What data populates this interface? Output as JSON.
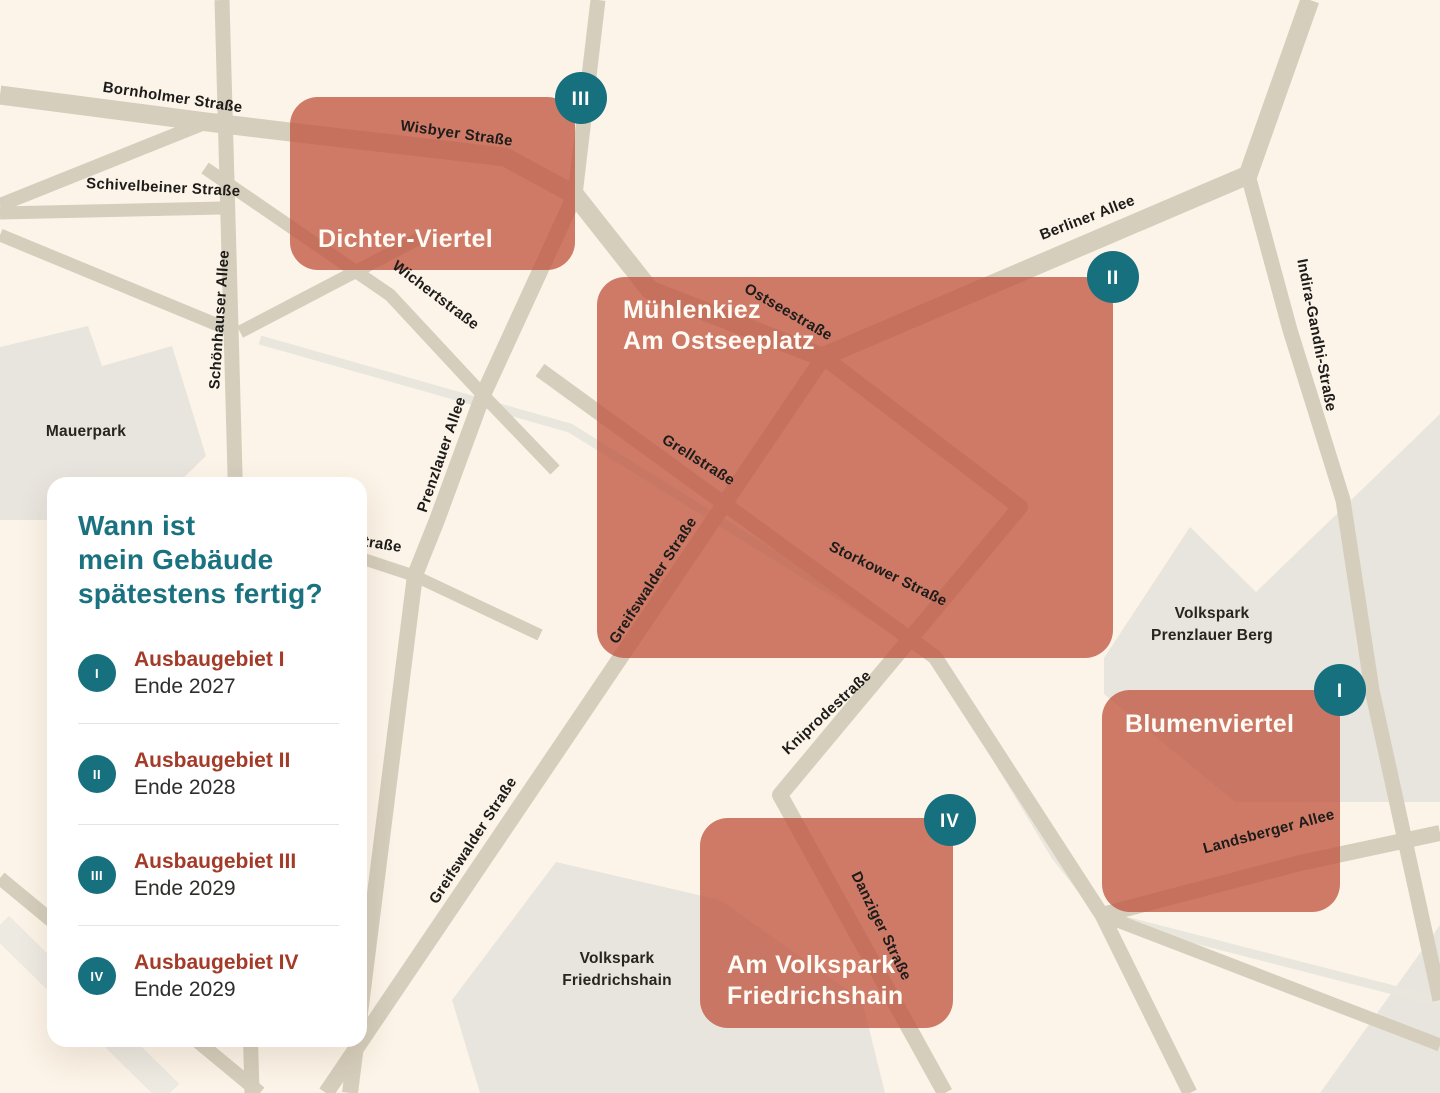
{
  "map": {
    "colors": {
      "background": "#fcf4e8",
      "street": "#d5cebc",
      "rail": "#e9e6dd",
      "rail_wide": "#edeae2",
      "park": "#e8e5de",
      "area": "#c05742",
      "area_opacity": 0.78,
      "badge": "#17707e",
      "street_label": "#1d1c1a",
      "area_label": "#fefaf4"
    },
    "parks": [
      {
        "id": "mauerpark",
        "points": "0,347 88,326 102,366 172,346 206,456 140,520 0,520"
      },
      {
        "id": "volkspark-prenzlauer-berg",
        "points": "1104,658 1190,527 1256,592 1440,414 1440,802 1235,802 1104,694"
      },
      {
        "id": "volkspark-friedrichshain",
        "points": "556,862 720,900 862,1000 885,1093 480,1093 452,1000"
      },
      {
        "id": "gray-bottom-right",
        "points": "1320,1093 1440,925 1440,1093"
      }
    ],
    "rails": [
      {
        "id": "ringbahn",
        "points": "260,340 570,428 935,655 1055,855 1102,915 1440,1002",
        "width": 9
      },
      {
        "id": "rail-bottom-left",
        "points": "0,925 170,1093",
        "width": 26,
        "wide": true
      }
    ],
    "streets": [
      {
        "id": "wisbyer-ostsee-berliner",
        "points": "0,95 207,122 290,132 505,157 575,195 650,290 822,357 1248,175 1310,0",
        "width": 19
      },
      {
        "id": "bornholmer-bruecke",
        "points": "0,205 207,122",
        "width": 14
      },
      {
        "id": "schivelbeiner-strasse",
        "points": "0,213 222,208",
        "width": 13
      },
      {
        "id": "schoenhauser-allee",
        "points": "222,0 252,1093",
        "width": 15
      },
      {
        "id": "top-vertical",
        "points": "598,0 575,195",
        "width": 15
      },
      {
        "id": "indira-gandhi-strasse",
        "points": "1248,175 1290,330 1343,500 1372,690 1440,1000",
        "width": 15
      },
      {
        "id": "prenzlauer-allee",
        "points": "575,195 483,395 437,520 415,575 350,1093",
        "width": 16
      },
      {
        "id": "wichertstrasse",
        "points": "205,168 390,295 483,395 555,470",
        "width": 13
      },
      {
        "id": "kuglerstrasse",
        "points": "420,238 240,332",
        "width": 13
      },
      {
        "id": "gleimstrasse",
        "points": "0,235 230,330",
        "width": 13
      },
      {
        "id": "greifswalder-strasse",
        "points": "825,355 326,1093",
        "width": 16
      },
      {
        "id": "grell-storkower",
        "points": "540,370 730,508 935,657 1102,915 1190,1093",
        "width": 15
      },
      {
        "id": "kniprode-danziger",
        "points": "830,362 1020,507 780,795 945,1093",
        "width": 16
      },
      {
        "id": "landsberger-allee",
        "points": "1102,915 1300,863 1440,833",
        "width": 16
      },
      {
        "id": "landsberger-sued-ost",
        "points": "1102,915 1440,1045",
        "width": 13
      },
      {
        "id": "strasse-partial",
        "points": "330,548 415,576 540,635",
        "width": 12
      },
      {
        "id": "bottom-left-diagonal",
        "points": "0,878 260,1093",
        "width": 14
      }
    ],
    "areas": [
      {
        "id": "dichter-viertel",
        "x": 290,
        "y": 97,
        "w": 285,
        "h": 173,
        "label_lines": [
          "Dichter-Viertel"
        ],
        "label_x": 318,
        "label_y": 247,
        "badge": {
          "numeral": "III",
          "cx": 581,
          "cy": 98
        }
      },
      {
        "id": "muehlenkiez-am-ostseeplatz",
        "x": 597,
        "y": 277,
        "w": 516,
        "h": 381,
        "label_lines": [
          "Mühlenkiez",
          "Am Ostseeplatz"
        ],
        "label_x": 623,
        "label_y": 318,
        "badge": {
          "numeral": "II",
          "cx": 1113,
          "cy": 277
        }
      },
      {
        "id": "blumenviertel",
        "x": 1102,
        "y": 690,
        "w": 238,
        "h": 222,
        "label_lines": [
          "Blumenviertel"
        ],
        "label_x": 1125,
        "label_y": 732,
        "badge": {
          "numeral": "I",
          "cx": 1340,
          "cy": 690
        }
      },
      {
        "id": "am-volkspark-friedrichshain",
        "x": 700,
        "y": 818,
        "w": 253,
        "h": 210,
        "label_lines": [
          "Am Volkspark",
          "Friedrichshain"
        ],
        "label_x": 727,
        "label_y": 973,
        "badge": {
          "numeral": "IV",
          "cx": 950,
          "cy": 820
        }
      }
    ],
    "street_labels": [
      {
        "text": "Bornholmer Straße",
        "x": 172,
        "y": 102,
        "rot": 8.5
      },
      {
        "text": "Schivelbeiner Straße",
        "x": 163,
        "y": 192,
        "rot": 3
      },
      {
        "text": "Schönhauser Allee",
        "x": 224,
        "y": 320,
        "rot": -86
      },
      {
        "text": "Wisbyer Straße",
        "x": 456,
        "y": 138,
        "rot": 8
      },
      {
        "text": "Wichertstraße",
        "x": 433,
        "y": 299,
        "rot": 37
      },
      {
        "text": "Prenzlauer Allee",
        "x": 446,
        "y": 456,
        "rot": -71
      },
      {
        "text": "traße",
        "x": 382,
        "y": 549,
        "rot": 9
      },
      {
        "text": "Ostseestraße",
        "x": 786,
        "y": 316,
        "rot": 30
      },
      {
        "text": "Berliner Allee",
        "x": 1089,
        "y": 222,
        "rot": -21
      },
      {
        "text": "Indira-Gandhi-Straße",
        "x": 1312,
        "y": 336,
        "rot": 79
      },
      {
        "text": "Grellstraße",
        "x": 696,
        "y": 464,
        "rot": 32
      },
      {
        "text": "Greifswalder Straße",
        "x": 657,
        "y": 583,
        "rot": -57
      },
      {
        "text": "Storkower Straße",
        "x": 886,
        "y": 578,
        "rot": 26
      },
      {
        "text": "Kniprodestraße",
        "x": 830,
        "y": 716,
        "rot": -43
      },
      {
        "text": "Greifswalder Straße",
        "x": 477,
        "y": 843,
        "rot": -57
      },
      {
        "text": "Danziger Straße",
        "x": 877,
        "y": 928,
        "rot": 64
      },
      {
        "text": "Landsberger Allee",
        "x": 1270,
        "y": 836,
        "rot": -15
      }
    ],
    "park_labels": [
      {
        "id": "mauerpark",
        "lines": [
          "Mauerpark"
        ],
        "x": 86,
        "y": 436
      },
      {
        "id": "volkspark-prenzlauer-berg",
        "lines": [
          "Volkspark",
          "Prenzlauer Berg"
        ],
        "x": 1212,
        "y": 618
      },
      {
        "id": "volkspark-friedrichshain",
        "lines": [
          "Volkspark",
          "Friedrichshain"
        ],
        "x": 617,
        "y": 963
      }
    ]
  },
  "legend": {
    "title_lines": [
      "Wann ist",
      "mein Gebäude",
      "spätestens fertig?"
    ],
    "title_color": "#1a7280",
    "accent_color": "#a33b28",
    "badge_color": "#17707e",
    "items": [
      {
        "numeral": "I",
        "title": "Ausbaugebiet I",
        "subtitle": "Ende 2027"
      },
      {
        "numeral": "II",
        "title": "Ausbaugebiet II",
        "subtitle": "Ende 2028"
      },
      {
        "numeral": "III",
        "title": "Ausbaugebiet III",
        "subtitle": "Ende 2029"
      },
      {
        "numeral": "IV",
        "title": "Ausbaugebiet IV",
        "subtitle": "Ende 2029"
      }
    ]
  }
}
